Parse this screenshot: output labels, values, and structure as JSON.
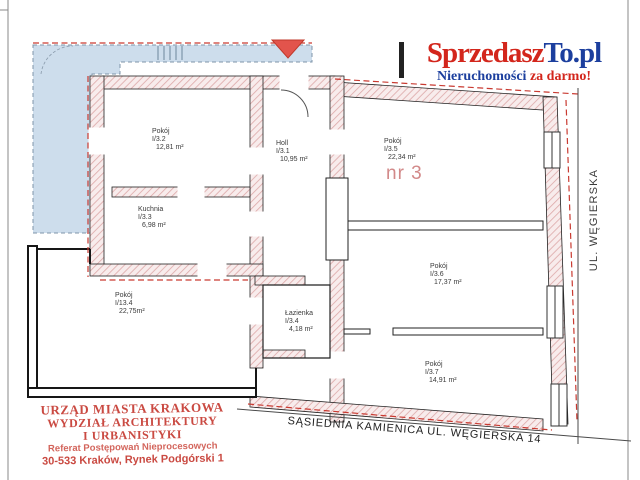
{
  "logo": {
    "brand_red": "Sprzedasz",
    "brand_blue": "To.pl",
    "tagline_blue": "Nieruchomości ",
    "tagline_red": "za darmo!",
    "colors": {
      "red": "#d3261c",
      "blue": "#1c3f9e"
    }
  },
  "plan": {
    "apartment_label": "nr 3",
    "street_label": "UL. WĘGIERSKA",
    "neighbor_label": "SĄSIEDNIA KAMIENICA UL. WĘGIERSKA 14",
    "rooms": [
      {
        "name": "Pokój",
        "unit": "I/3.2",
        "area": "12,81 m²"
      },
      {
        "name": "Holl",
        "unit": "I/3.1",
        "area": "10,95 m²"
      },
      {
        "name": "Pokój",
        "unit": "I/3.5",
        "area": "22,34 m²"
      },
      {
        "name": "Kuchnia",
        "unit": "I/3.3",
        "area": "6,98 m²"
      },
      {
        "name": "Pokój",
        "unit": "I/13.4",
        "area": "22,75m²"
      },
      {
        "name": "Łazienka",
        "unit": "I/3.4",
        "area": "4,18 m²"
      },
      {
        "name": "Pokój",
        "unit": "I/3.6",
        "area": "17,37 m²"
      },
      {
        "name": "Pokój",
        "unit": "I/3.7",
        "area": "14,91 m²"
      }
    ],
    "colors": {
      "wall_hatch": "#dda8a8",
      "boundary_red": "#c93a31",
      "courtyard_blue": "#cdddec",
      "nr_label": "#d28989",
      "entrance_marker": "#e2544c"
    }
  },
  "stamp": {
    "line1": "URZĄD MIASTA KRAKOWA",
    "line2": "WYDZIAŁ ARCHITEKTURY",
    "line3": "I URBANISTYKI",
    "line4": "Referat Postępowań Nieprocesowych",
    "line5": "30-533 Kraków, Rynek Podgórski 1",
    "color": "#ca4a42"
  }
}
